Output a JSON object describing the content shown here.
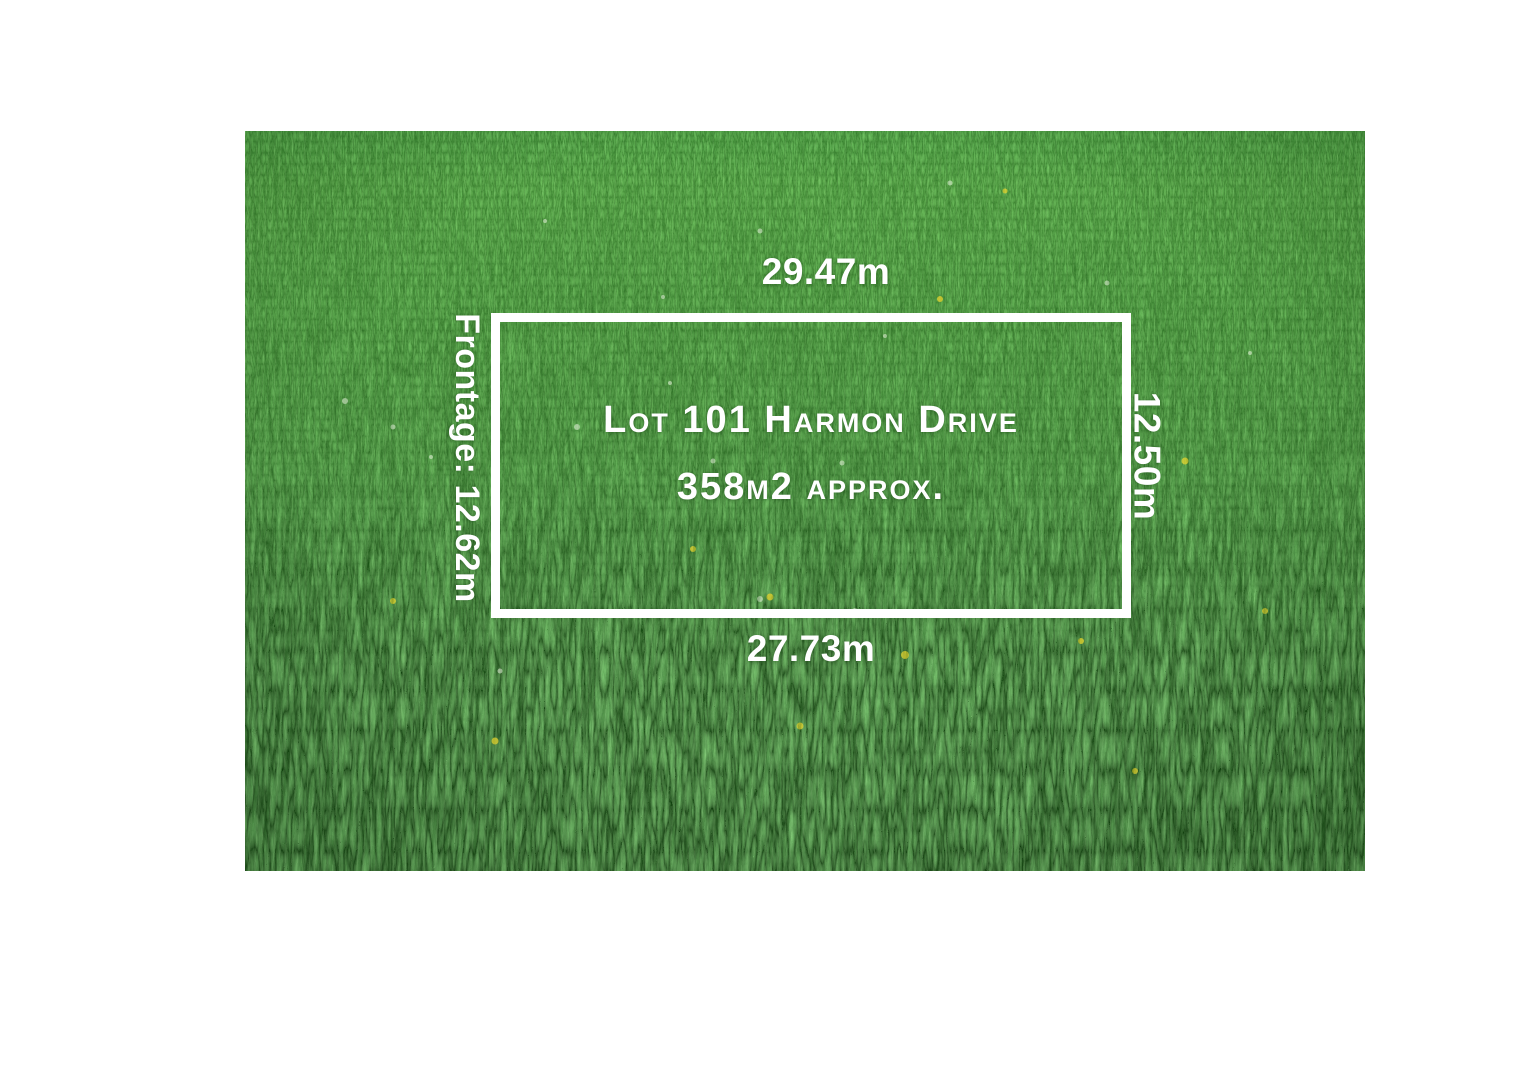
{
  "lot_sign": {
    "title": "Lot 101 Harmon Drive",
    "area": "358m2 approx.",
    "dimensions": {
      "top": "29.47m",
      "bottom": "27.73m",
      "left": "Frontage: 12.62m",
      "right": "12.50m"
    }
  },
  "colors": {
    "page_background": "#ffffff",
    "boundary_line": "#ffffff",
    "label_text": "#ffffff",
    "grass_light": "#4c9c33",
    "grass_mid": "#388626",
    "grass_dark": "#2b731d"
  }
}
